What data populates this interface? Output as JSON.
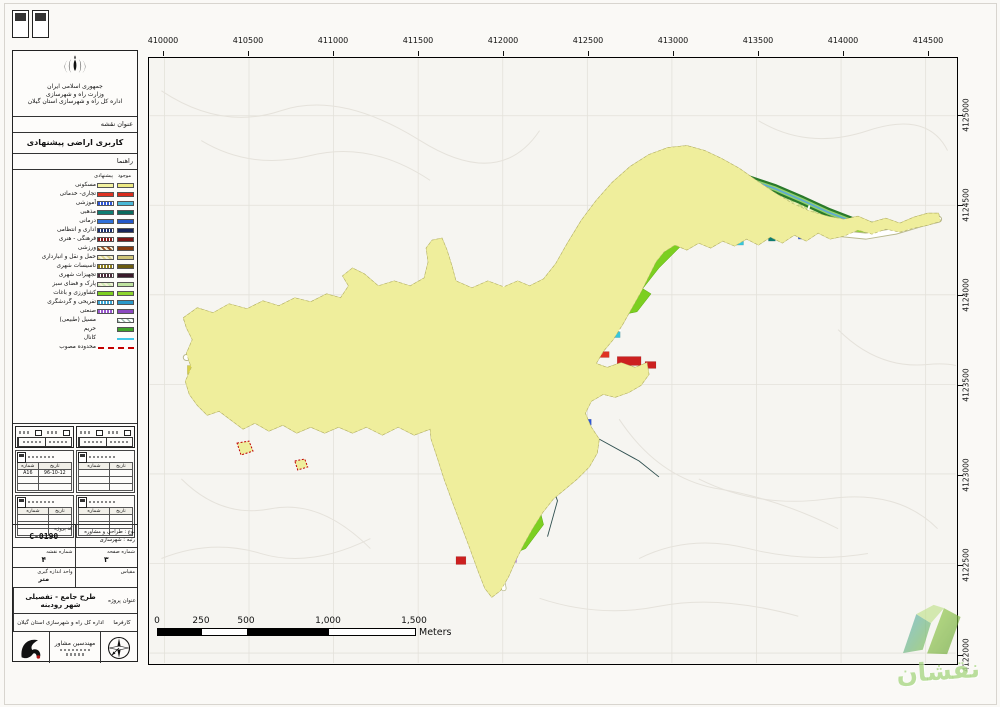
{
  "header": {
    "line1": "جمهوری اسلامی ایران",
    "line2": "وزارت راه و شهرسازی",
    "line3": "اداره کل راه و شهرسازی استان گیلان"
  },
  "title_block": {
    "label": "عنوان نقشه",
    "title": "کاربری اراضی پیشنهادی"
  },
  "legend": {
    "heading": "راهنما",
    "col_proposed": "پیشنهادی",
    "col_existing": "موجود",
    "items": [
      {
        "label": "مسکونی",
        "prop": "#F3F2A0",
        "exist": "#EDE982",
        "style": "solid"
      },
      {
        "label": "تجاری- خدماتی",
        "prop": "#DF3222",
        "exist": "#D92B1C",
        "style": "solid"
      },
      {
        "label": "آموزشی",
        "prop": "#2E57D8",
        "exist": "#49B8D6",
        "style": "stripes"
      },
      {
        "label": "مذهبی",
        "prop": "#0E7D72",
        "exist": "#0B6B5E",
        "style": "solid"
      },
      {
        "label": "درمانی",
        "prop": "#2E6FD8",
        "exist": "#2458C8",
        "style": "solid"
      },
      {
        "label": "اداری و انتظامی",
        "prop": "#1A2E6E",
        "exist": "#16255C",
        "style": "stripes"
      },
      {
        "label": "فرهنگی - هنری",
        "prop": "#8A1A1A",
        "exist": "#7A1515",
        "style": "stripes"
      },
      {
        "label": "ورزشی",
        "prop": "#96491E",
        "exist": "#86390E",
        "style": "dots"
      },
      {
        "label": "حمل و نقل و انبارداری",
        "prop": "#DCD28A",
        "exist": "#D0C67A",
        "style": "dots"
      },
      {
        "label": "تاسیسات شهری",
        "prop": "#8F7F1A",
        "exist": "#6B5B10",
        "style": "stripes"
      },
      {
        "label": "تجهیزات شهری",
        "prop": "#4A2A3A",
        "exist": "#3A1A2A",
        "style": "stripes"
      },
      {
        "label": "پارک و فضای سبز",
        "prop": "#CDEBB4",
        "exist": "#BFE3A0",
        "style": "dots"
      },
      {
        "label": "کشاورزی و باغات",
        "prop": "#7CCF21",
        "exist": "#8CD52E",
        "style": "solid"
      },
      {
        "label": "تفریحی و گردشگری",
        "prop": "#3AA8D8",
        "exist": "#2A98C8",
        "style": "stripes"
      },
      {
        "label": "صنعتی",
        "prop": "#9B59D0",
        "exist": "#8B49C0",
        "style": "stripes"
      },
      {
        "label": "مسیل (طبیعی)",
        "single": "#9FBFB2",
        "style": "hatch"
      },
      {
        "label": "حریم",
        "single": "#3FA32A",
        "style": "solid"
      },
      {
        "label": "کانال",
        "type": "line",
        "color": "#44C8E8"
      },
      {
        "label": "محدوده مصوب",
        "type": "dash",
        "color": "#C40000"
      }
    ]
  },
  "revision": {
    "cols": [
      "شماره",
      "تاریخ"
    ],
    "blocks": [
      {
        "rows": [
          [
            "A16",
            "96-10-12"
          ],
          [
            "",
            ""
          ],
          [
            "",
            ""
          ]
        ]
      },
      {
        "rows": [
          [
            "",
            ""
          ],
          [
            "",
            ""
          ],
          [
            "",
            ""
          ]
        ]
      },
      {
        "rows": [
          [
            "",
            ""
          ],
          [
            "",
            ""
          ],
          [
            "",
            ""
          ]
        ]
      },
      {
        "rows": [
          [
            "",
            ""
          ],
          [
            "",
            ""
          ],
          [
            "",
            ""
          ]
        ]
      }
    ]
  },
  "info": {
    "code_label": "کد پروژه",
    "code_value": "C-0190",
    "type_line1": "نوع : طراحی و مشاوره",
    "type_line2": "رتبه : شهرسازی",
    "sheet_label": "شماره نقشه",
    "sheet_value": "۴",
    "page_label": "شماره صفحه",
    "page_value": "۳",
    "unit_label": "واحد اندازه گیری",
    "unit_value": "متر",
    "scale_label": "مقیاس",
    "scale_value": "",
    "project_label": "عنوان پروژه",
    "project_line1": "طرح جامع - تفصیلی",
    "project_line2": "شهر رودبنه",
    "client_label": "کارفرما",
    "client_value": "اداره کل راه و شهرسازی استان گیلان",
    "consultant": "مهندسین مشاور"
  },
  "map": {
    "x_labels": [
      "410000",
      "410500",
      "411000",
      "411500",
      "412000",
      "412500",
      "413000",
      "413500",
      "414000",
      "414500"
    ],
    "y_labels": [
      "4125000",
      "4124500",
      "4124000",
      "4123500",
      "4123000",
      "4122500",
      "4122000"
    ],
    "scale_bar": {
      "labels": [
        "0",
        "250",
        "500",
        "1,000",
        "1,500"
      ],
      "unit": "Meters"
    }
  },
  "watermark": {
    "text": "نقشان"
  }
}
